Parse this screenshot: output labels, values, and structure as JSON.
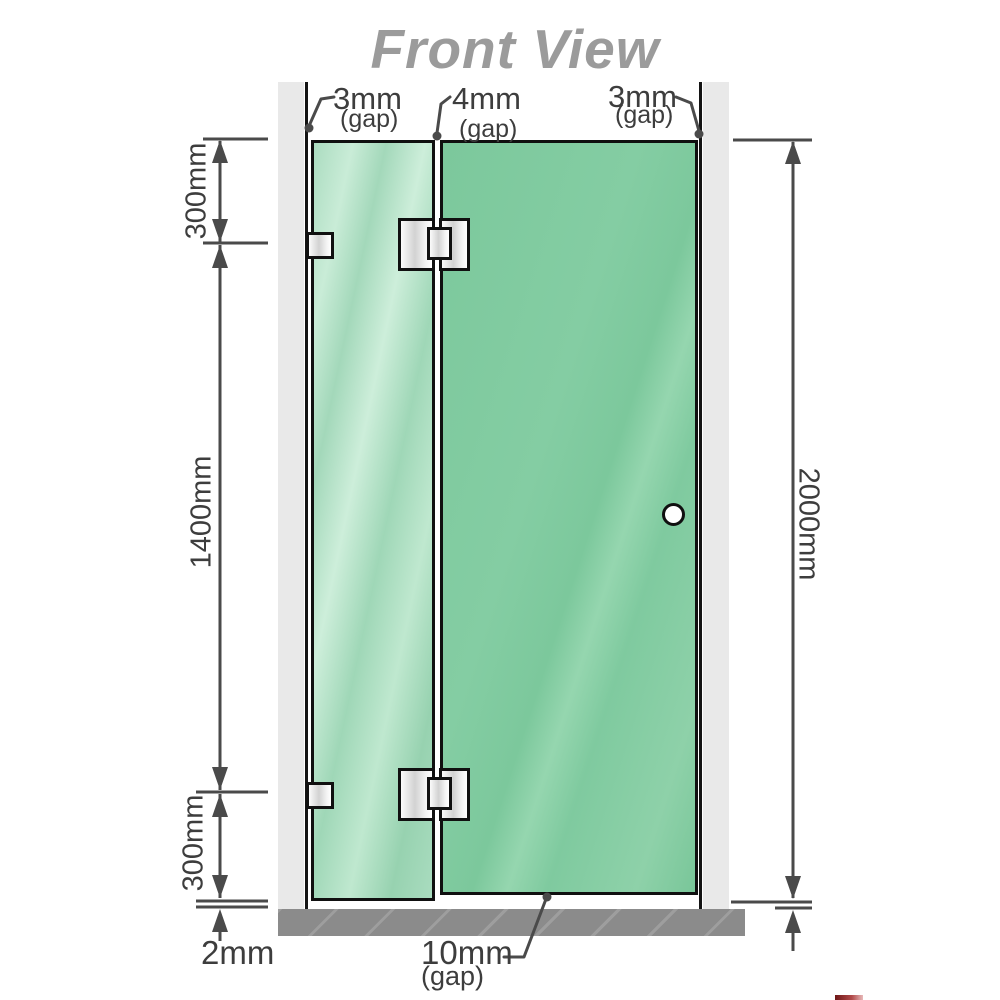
{
  "title": "Front View",
  "diagram": {
    "gap_labels": {
      "left": {
        "value": "3mm",
        "unit": "(gap)"
      },
      "middle": {
        "value": "4mm",
        "unit": "(gap)"
      },
      "right": {
        "value": "3mm",
        "unit": "(gap)"
      },
      "bottom_door": {
        "value": "10mm",
        "unit": "(gap)"
      },
      "bottom_panel": {
        "value": "2mm"
      }
    },
    "dimensions": {
      "top_section": "300mm",
      "middle_section": "1400mm",
      "bottom_section": "300mm",
      "total_height": "2000mm"
    },
    "parts": {
      "fixed_panel": "glass-fixed-panel",
      "door_panel": "glass-door-panel",
      "hinges": 2,
      "wall_brackets": 2
    }
  },
  "colors": {
    "glass_fixed": "#aedec4",
    "glass_door": "#7cc89c",
    "wall": "#e9e9e9",
    "base": "#8b8b8b",
    "dimension_lines": "#4a4a4a",
    "label_text": "#3d3d3d",
    "title_text": "#9b9b9b",
    "hardware": "#e6e6e6",
    "corner_mark": "#b14a4a"
  }
}
